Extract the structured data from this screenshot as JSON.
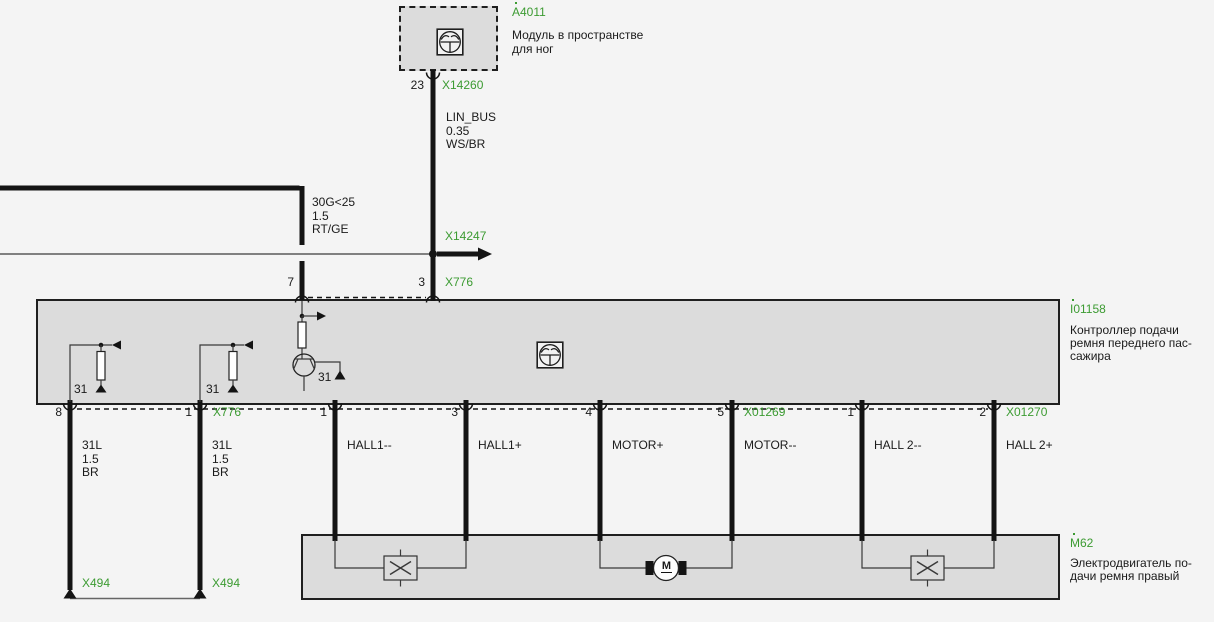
{
  "colors": {
    "accent_green": "#3C9B32",
    "module_fill": "#DCDCDC",
    "page_background": "#F4F4F4",
    "wire_black": "#141414"
  },
  "modules": {
    "a4011": {
      "id": "A4011",
      "desc": [
        "Модуль в пространстве",
        "для ног"
      ],
      "pin": "23",
      "connector": "X14260"
    },
    "i01158": {
      "id": "I01158",
      "desc": [
        "Контроллер подачи",
        "ремня переднего пас-",
        "сажира"
      ],
      "internal_ground_labels": [
        "31",
        "31",
        "31"
      ]
    },
    "m62": {
      "id": "M62",
      "desc": [
        "Электродвигатель по-",
        "дачи ремня правый"
      ],
      "motor_symbol": "M"
    }
  },
  "wires": {
    "lin_bus": {
      "signal": "LIN_BUS",
      "cross_section": "0.35",
      "color_code": "WS/BR"
    },
    "supply": {
      "signal": "30G<25",
      "cross_section": "1.5",
      "color_code": "RT/GE"
    },
    "ground_left": {
      "signal": "31L",
      "cross_section": "1.5",
      "color_code": "BR"
    },
    "ground_right": {
      "signal": "31L",
      "cross_section": "1.5",
      "color_code": "BR"
    },
    "hall1_minus": "HALL1--",
    "hall1_plus": "HALL1+",
    "motor_plus": "MOTOR+",
    "motor_minus": "MOTOR--",
    "hall2_minus": "HALL 2--",
    "hall2_plus": "HALL 2+"
  },
  "connectors": {
    "x14260": "X14260",
    "x14247": "X14247",
    "x776_top": "X776",
    "x776_bottom": "X776",
    "x01269": "X01269",
    "x01270": "X01270",
    "x494_left": "X494",
    "x494_right": "X494"
  },
  "pins": {
    "a4011_pin": "23",
    "top_pin_7": "7",
    "top_pin_3": "3",
    "bottom": [
      "8",
      "1",
      "1",
      "3",
      "4",
      "5",
      "1",
      "2"
    ]
  }
}
